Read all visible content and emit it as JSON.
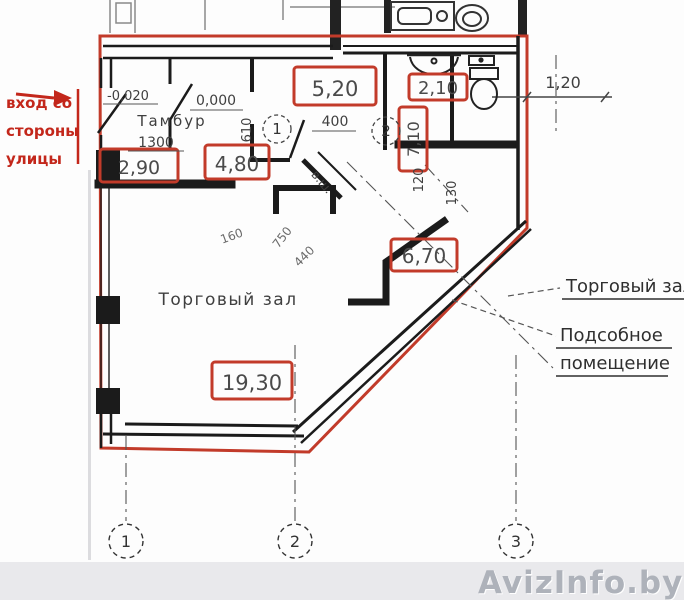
{
  "entry_note": {
    "l1": "вход со",
    "l2": "стороны",
    "l3": "улицы"
  },
  "plan": {
    "tambour": "Тамбур",
    "hall": "Торговый зал",
    "level_out": "-0,020",
    "level_in": "0,000",
    "vent_shaft": "в.ш."
  },
  "areas": {
    "tambour": "2,90",
    "corridor": "4,80",
    "room_top": "5,20",
    "wc": "2,10",
    "wc2": "7,10",
    "utility": "6,70",
    "hall": "19,30"
  },
  "dims": {
    "d1300": "1300",
    "d400": "400",
    "d610": "610",
    "d120": "120",
    "d130": "130",
    "d160": "160",
    "d750": "750",
    "d440": "440",
    "right_offset": "1,20"
  },
  "legend": {
    "hall": "Торговый зал",
    "utility_line1": "Подсобное",
    "utility_line2": "помещение"
  },
  "axis": {
    "a1": "1",
    "a2": "2",
    "a3": "3"
  },
  "markers": {
    "m1": "1",
    "m2": "2"
  },
  "watermark": "AvizInfo.by",
  "colors": {
    "red": "#c23b2a",
    "ink": "#1b1b1b",
    "box_number": "#4a4a4a",
    "watermark": "#aeb2ba"
  }
}
